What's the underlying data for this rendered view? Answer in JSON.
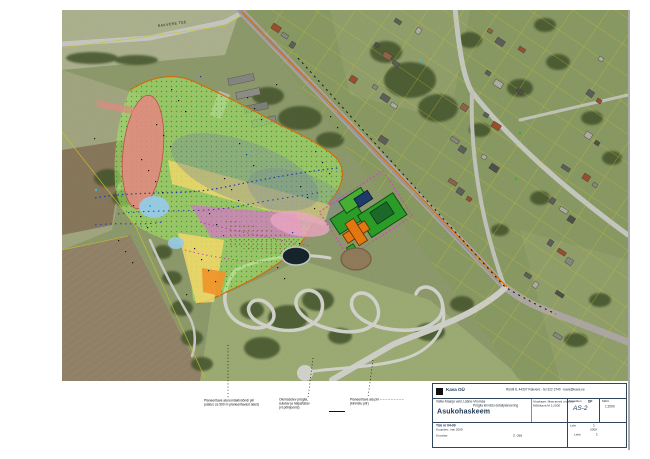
{
  "map": {
    "road_label": "RAKVERE TEE",
    "zone_colors": {
      "planned_area": "#a9ee6b",
      "landfill_body": "#eb9186",
      "buffer_yellow": "#ffe370",
      "buffer_orange": "#fb9d2e",
      "buffer_magenta": "#e86fe0",
      "buffer_pink": "#f6aecb",
      "water_blue": "#9fd4f2",
      "overlay_gray": "#7e90a4",
      "planned_green": "#2ea42b",
      "planned_orange": "#ef7d12",
      "planned_navy": "#1f3f70",
      "planned_darkgreen": "#1d6f2d",
      "boundary_orange": "#e36d00"
    }
  },
  "annotations": [
    {
      "lines": [
        "Planeeritava ala kontaktvööndi piir",
        "(ulatus ca 500 m planeeritavast alast)"
      ]
    },
    {
      "lines": [
        "Olemasolev prügila,",
        "suletav ja haljastatav",
        "(vt põhijoonis)"
      ]
    },
    {
      "lines": [
        "Planeeritava ala piir  – – – – – – – – –",
        "(kinnistu piir)"
      ]
    }
  ],
  "titleblock": {
    "company": "Kava OÜ",
    "contact_line": "Rüütli 8, 44307 Rakvere · tel 322 3740 · kava@kava.ee",
    "project_line1": "Väike-Maarja vald, Lääne-Virumaa",
    "project_line2": "Prügila kinnistu detailplaneering",
    "title": "Asukohaskeem",
    "base_line1": "Aluskaart: Maa-ameti ortofoto",
    "base_line2": "Mõõtkava M 1:2000",
    "stage_label": "Staadium",
    "stage_value": "DP",
    "drawing_no": "AS-2",
    "scale_label": "Mõõt",
    "scale_value": "1:2000",
    "work_no": "Töö nr 04-09",
    "date_line": "Kuupäev: mai 2009",
    "author_line": "Koostas:",
    "part_label": "2. osa",
    "sheet_label": "Leht",
    "sheet_value": "1",
    "sheets_label": "Lehti",
    "sheets_value": "1",
    "year_note": "2009"
  }
}
